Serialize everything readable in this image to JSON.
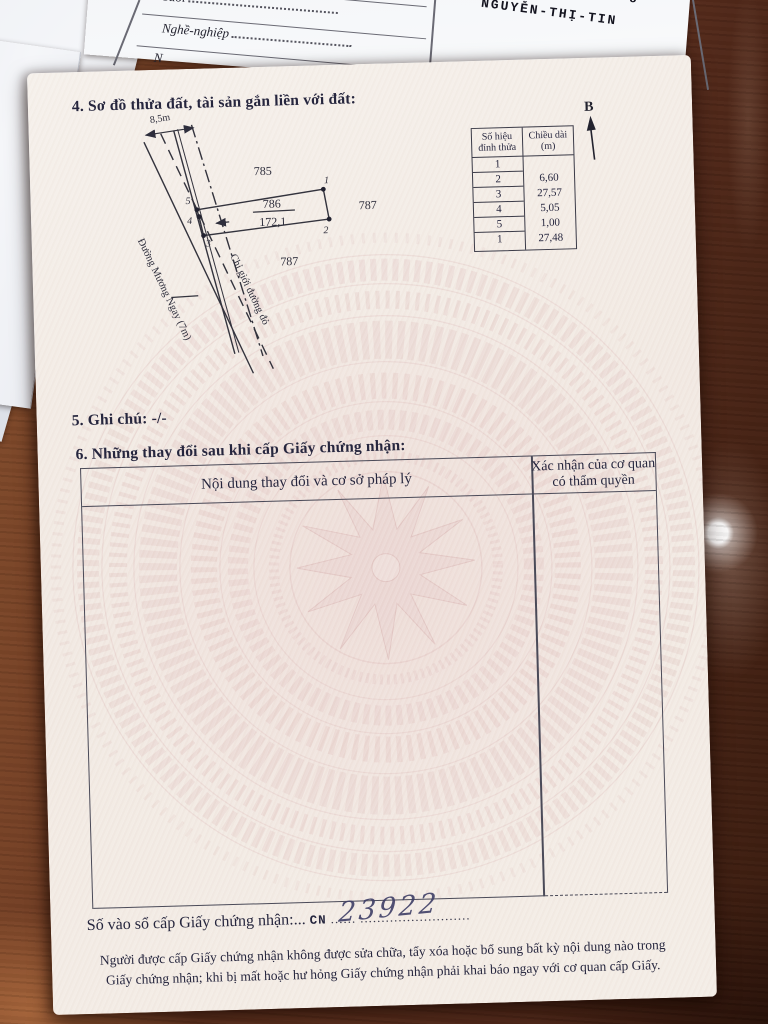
{
  "colors": {
    "wood_dark": "#3a1c0f",
    "wood_mid": "#643420",
    "wood_light": "#86502e",
    "paper_cream": "#f2eae2",
    "watermark_pink": "#dcb9b7",
    "ink": "#26263e",
    "handwriting_ink": "#3e3e66"
  },
  "underlying_form": {
    "fields": [
      {
        "label": "Tuổi"
      },
      {
        "label": "Nghề-nghiệp"
      },
      {
        "label": "N"
      }
    ],
    "typed_line1": "n Chương Dương",
    "typed_line2": "NGUYỄN-THỊ-TIN",
    "bracket": ")"
  },
  "certificate": {
    "section4": {
      "heading": "4. Sơ đồ thửa đất, tài sản gắn liền với đất:",
      "diagram": {
        "dimension_label": "8,5m",
        "road_label": "Đường Mương Ngay (7m)",
        "red_line_label": "Chỉ giới đường đỏ",
        "parcel_number": "786",
        "parcel_area": "172,1",
        "neighbor_top": "785",
        "neighbor_right": "787",
        "neighbor_bottom": "787",
        "vertex_1": "1",
        "vertex_2": "2",
        "vertex_3": "3",
        "vertex_4": "4",
        "vertex_5": "5",
        "north_label": "B"
      },
      "vertex_table": {
        "header_col1": "Số hiệu đỉnh thửa",
        "header_col2": "Chiều dài (m)",
        "rows": [
          {
            "vertex": "1",
            "length": ""
          },
          {
            "vertex": "2",
            "length": "6,60"
          },
          {
            "vertex": "3",
            "length": "27,57"
          },
          {
            "vertex": "4",
            "length": "5,05"
          },
          {
            "vertex": "5",
            "length": "1,00"
          },
          {
            "vertex": "1",
            "length": "27,48"
          }
        ]
      }
    },
    "section5": {
      "heading": "5. Ghi chú: -/-"
    },
    "section6": {
      "heading": "6. Những thay đổi sau khi cấp Giấy chứng nhận:",
      "table": {
        "col1_header": "Nội dung thay đổi và cơ sở pháp lý",
        "col2_header_line1": "Xác nhận của cơ quan",
        "col2_header_line2": "có thẩm quyền"
      }
    },
    "footer": {
      "register_label": "Số vào sổ cấp Giấy chứng nhận:...",
      "register_prefix": "CN",
      "register_dots1": "......",
      "register_number_handwritten": "23922",
      "register_dots2": "..........................",
      "notice_line1": "Người được cấp Giấy chứng nhận không được sửa chữa, tẩy xóa hoặc bổ sung bất kỳ nội dung nào trong",
      "notice_line2": "Giấy chứng nhận; khi bị mất hoặc hư hỏng Giấy chứng nhận phải khai báo ngay với cơ quan cấp Giấy."
    }
  }
}
